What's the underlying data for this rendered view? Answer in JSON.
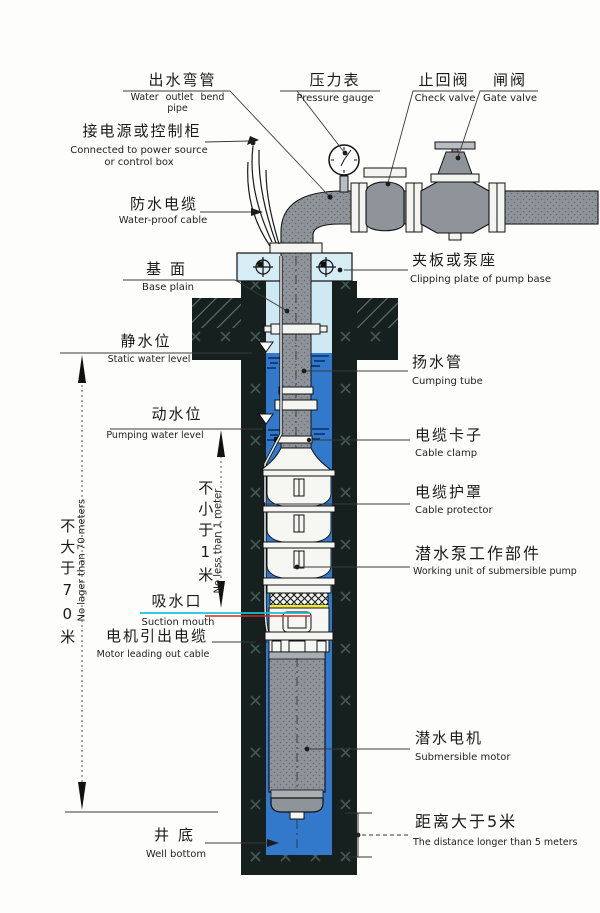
{
  "diagram_title": "Submersible pump well installation diagram",
  "labels": {
    "water_outlet": {
      "cn": "出水弯管",
      "en": "Water outlet bend pipe"
    },
    "pressure_gauge": {
      "cn": "压力表",
      "en": "Pressure gauge"
    },
    "check_valve": {
      "cn": "止回阀",
      "en": "Check valve"
    },
    "gate_valve": {
      "cn": "闸阀",
      "en": "Gate valve"
    },
    "power_source": {
      "cn": "接电源或控制柜",
      "en": "Connected to power source",
      "en2": "or control box"
    },
    "waterproof_cable": {
      "cn": "防水电缆",
      "en": "Water-proof cable"
    },
    "base_plain": {
      "cn": "基面",
      "en": "Base plain"
    },
    "clipping_plate": {
      "cn": "夹板或泵座",
      "en": "Clipping plate of pump base"
    },
    "static_water_level": {
      "cn": "静水位",
      "en": "Static water level"
    },
    "pumping_tube": {
      "cn": "扬水管",
      "en": "Cumping tube"
    },
    "pumping_water_level": {
      "cn": "动水位",
      "en": "Pumping water level"
    },
    "cable_clamp": {
      "cn": "电缆卡子",
      "en": "Cable clamp"
    },
    "cable_protector": {
      "cn": "电缆护罩",
      "en": "Cable protector"
    },
    "working_unit": {
      "cn": "潜水泵工作部件",
      "en": "Working unit of submersible pump"
    },
    "suction_mouth": {
      "cn": "吸水口",
      "en": "Suction mouth"
    },
    "motor_cable": {
      "cn": "电机引出电缆",
      "en": "Motor leading out cable"
    },
    "depth_limit": {
      "cn": "不大于70米",
      "en": "No lager than 70 meters"
    },
    "min_submergence": {
      "cn": "不小于1米",
      "en": "No less than 1 meter"
    },
    "submersible_motor": {
      "cn": "潜水电机",
      "en": "Submersible motor"
    },
    "well_bottom": {
      "cn": "井底",
      "en": "Well bottom"
    },
    "bottom_distance": {
      "cn": "距离大于5米",
      "en": "The distance longer than 5 meters"
    }
  },
  "colors": {
    "pipe_gray": "#8e9499",
    "plate_light_blue": "#d7edf6",
    "water_blue": "#3279cc",
    "ground_dark": "#16201e",
    "suction_line_cyan": "#19c2d8",
    "suction_line_red": "#cf2b25",
    "suction_band_yellow": "#efe73a"
  }
}
